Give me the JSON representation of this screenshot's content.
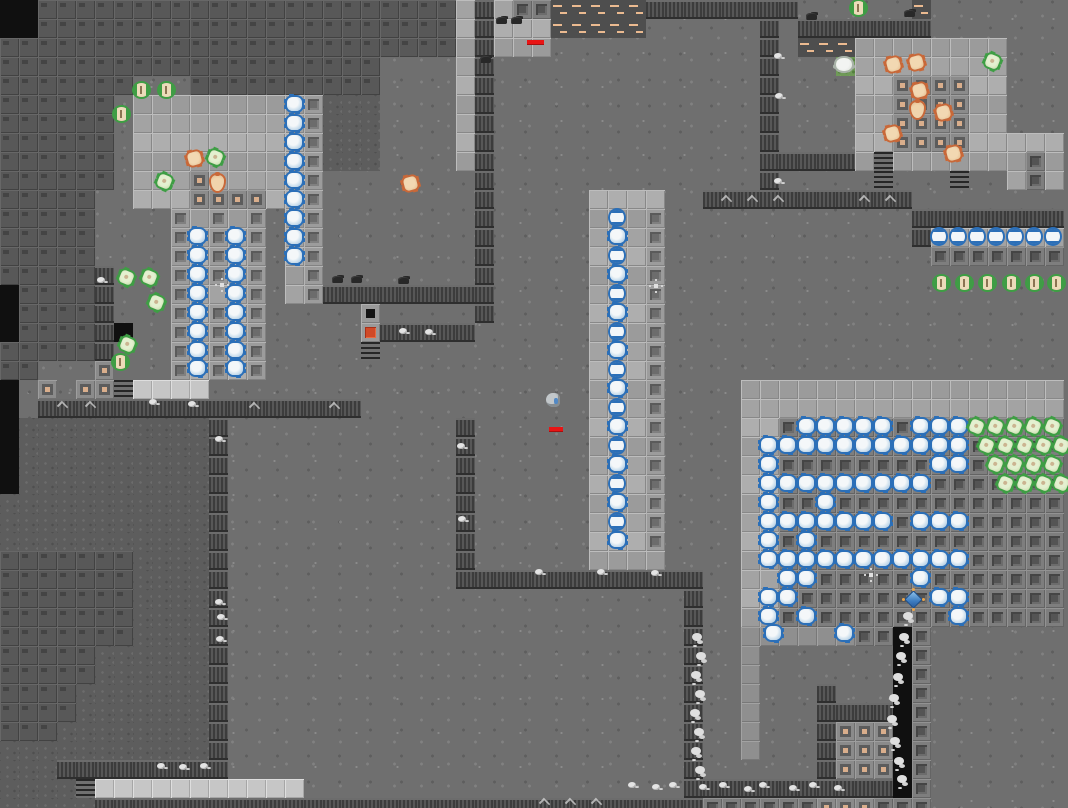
{
  "meta": {
    "title": "fortress-map-viewport",
    "tile_size": 19,
    "cols": 56,
    "rows": 43,
    "width": 1068,
    "height": 808
  },
  "palette": {
    "rough_floor": "#6f6f6f",
    "dark_rough_floor": "#5d5d5d",
    "rock": "#585858",
    "smooth_floor": "#a3a3a3",
    "bright_floor": "#c6c6c6",
    "wall_dark": "#3c3c3c",
    "wall_light": "#575757",
    "tan_accent": "#d9ae8c",
    "track_dash": "#ebba90",
    "blue_creature": "#2b6fb8",
    "green_creature": "#3e9e44",
    "orange_creature": "#c96838",
    "red_trap": "#d04a28",
    "health_red": "#e81414",
    "gem_blue": "#3d7cc0",
    "gem_dot_orange": "#e8a44c"
  },
  "legend": {
    "#": "rock-block",
    ".": "rough-floor",
    ",": "dark-rough-floor",
    "s": "smooth-floor",
    "S": "bright-floor",
    "m": "mid-floor",
    "i": "inset-floor",
    "I": "inset-floor-dark",
    "t": "tan-center-tile",
    "h": "hatch",
    "r": "red-trap",
    "w": "wall-band",
    "d": "track-dash-tile",
    "%": "stairs",
    "x": "void-black",
    "g": "mossy-tile"
  },
  "map": [
    "xx######################swsIIdddddwwwwwwww......d.......",
    "xx######################swsssddddd......w.wwwwwww.......",
    "########################swsss...........w.dddssssssss...",
    "####################....sw..............w...gssssssss...",
    "#######...##########....sw..............w....ssttttss...",
    "######.sssssssssi,,,....sw..............w....ssttttss...",
    "######.sssssssssi,,,....sw..............w....ssttttss...",
    "######.sssssssssi,,,....sw..............w....ssttttsssss",
    "######.sssssssssi,,,....sw..............wwwwws%sssssssIs",
    "######.ssstsssssi........w..............w.....%...%..sIs",
    "#####..sssttttssi........w.....ssss..wwwwwwwwwww........",
    "#####....isisi.si........w.....sssi.............wwwwwwww",
    "#####....isisi.si........w.....sssi.............wsssssss",
    "#####....isisi.si........w.....sssi..............IIIIIII",
    "#####w...isisi.si........w.....sssi.....................",
    "x####w...isssi.siwwwwwwwww.....sssi.....................",
    "x####w...isisi.....h.....w.....sssi.....................",
    "x####wx..isisi.....rwwwww......sssi.....................",
    "#####w...isisi.....%...........sssi.....................",
    "##...t...isisi.................sssi.....................",
    "x.t.tt%SSSS....................sssi....sssssssssssssssss",
    "x.wwwwwwwwwwwwwwwww............sssi....sssssssssssssssss",
    "x,,,,,,,,,,w............w......sssi....ssIIIIIIIIIIIIIII",
    "x,,,,,,,,,,w............w......sssi....ssIIIIIIIIIIIIIII",
    "x,,,,,,,,,,w............w......sssi....ssIIIIIIIIIIIIIII",
    "x,,,,,,,,,,w............w......sssi....ssIIIIIIIIIIIIIII",
    ",,,,,,,,,,,w............w......sssi....ssIIIIIIIIIIIIIII",
    ",,,,,,,,,,,w............w......sssi....ssIIIIIIIIIIIIIII",
    ",,,,,,,,,,,w............w......sssi....ssIIIIIIIIIIIIIII",
    "#######,,,,w............w......ssss....ssIIIIIIIIIIIIIII",
    "#######,,,,w............wwwwwwwwwwwww..ssIIIIIIIIIIIIIII",
    "#######,,,,w........................w..ssIIIIIIIIIIIIIII",
    "#######,,,,w........................w..ssIIIIIIIIIIIIIII",
    "#######,,,,w........................w..mmmmmmIIxI.......",
    "#####,,,,,,w........................w..m.......xI.......",
    "#####,,,,,,w........................w..m.......xI.......",
    "####,,,,,,,w........................w..m...w...xI.......",
    "####,,,,,,,w........................w..m...wwwwxI.......",
    "###,,,,,,,,w........................w..m...wtttxI.......",
    ",,,,,,,,,,,w........................w..m...wtttxI.......",
    ",,,wwwwwwwww........................w......wtttxI.......",
    ",,,,%SSSSSSSSSSS....................wwwwwwwwwwwxI.......",
    ",,,,,wwwwwwwwwwwwwwwwwwwwwwwwwwwwwwwwIIIIIItttIII......."
  ],
  "sprites": {
    "blue_bug": [
      [
        287,
        97
      ],
      [
        287,
        116
      ],
      [
        287,
        135
      ],
      [
        287,
        154
      ],
      [
        287,
        173
      ],
      [
        287,
        192
      ],
      [
        287,
        211
      ],
      [
        287,
        230
      ],
      [
        287,
        249
      ],
      [
        190,
        229
      ],
      [
        190,
        248
      ],
      [
        190,
        267
      ],
      [
        190,
        286
      ],
      [
        190,
        305
      ],
      [
        190,
        324
      ],
      [
        190,
        343
      ],
      [
        190,
        361
      ],
      [
        228,
        229
      ],
      [
        228,
        248
      ],
      [
        228,
        267
      ],
      [
        228,
        286
      ],
      [
        228,
        305
      ],
      [
        228,
        324
      ],
      [
        228,
        343
      ],
      [
        228,
        361
      ],
      [
        610,
        229
      ],
      [
        610,
        267
      ],
      [
        610,
        305
      ],
      [
        610,
        343
      ],
      [
        610,
        381
      ],
      [
        610,
        419
      ],
      [
        610,
        457
      ],
      [
        610,
        495
      ],
      [
        610,
        533
      ],
      [
        799,
        419
      ],
      [
        818,
        419
      ],
      [
        837,
        419
      ],
      [
        856,
        419
      ],
      [
        875,
        419
      ],
      [
        913,
        419
      ],
      [
        932,
        419
      ],
      [
        951,
        419
      ],
      [
        761,
        438
      ],
      [
        780,
        438
      ],
      [
        799,
        438
      ],
      [
        818,
        438
      ],
      [
        837,
        438
      ],
      [
        856,
        438
      ],
      [
        875,
        438
      ],
      [
        894,
        438
      ],
      [
        913,
        438
      ],
      [
        932,
        438
      ],
      [
        951,
        438
      ],
      [
        761,
        457
      ],
      [
        932,
        457
      ],
      [
        951,
        457
      ],
      [
        761,
        476
      ],
      [
        780,
        476
      ],
      [
        799,
        476
      ],
      [
        818,
        476
      ],
      [
        837,
        476
      ],
      [
        856,
        476
      ],
      [
        875,
        476
      ],
      [
        894,
        476
      ],
      [
        913,
        476
      ],
      [
        761,
        495
      ],
      [
        818,
        495
      ],
      [
        761,
        514
      ],
      [
        780,
        514
      ],
      [
        799,
        514
      ],
      [
        818,
        514
      ],
      [
        837,
        514
      ],
      [
        856,
        514
      ],
      [
        875,
        514
      ],
      [
        913,
        514
      ],
      [
        932,
        514
      ],
      [
        951,
        514
      ],
      [
        761,
        533
      ],
      [
        799,
        533
      ],
      [
        761,
        552
      ],
      [
        780,
        552
      ],
      [
        799,
        552
      ],
      [
        818,
        552
      ],
      [
        837,
        552
      ],
      [
        856,
        552
      ],
      [
        875,
        552
      ],
      [
        894,
        552
      ],
      [
        913,
        552
      ],
      [
        932,
        552
      ],
      [
        951,
        552
      ],
      [
        780,
        571
      ],
      [
        799,
        571
      ],
      [
        913,
        571
      ],
      [
        761,
        590
      ],
      [
        780,
        590
      ],
      [
        932,
        590
      ],
      [
        951,
        590
      ],
      [
        761,
        609
      ],
      [
        799,
        609
      ],
      [
        951,
        609
      ],
      [
        766,
        626
      ],
      [
        837,
        626
      ]
    ],
    "blue_egg": [
      [
        610,
        210
      ],
      [
        610,
        248
      ],
      [
        610,
        286
      ],
      [
        610,
        324
      ],
      [
        610,
        362
      ],
      [
        610,
        400
      ],
      [
        610,
        438
      ],
      [
        610,
        476
      ],
      [
        610,
        514
      ],
      [
        932,
        229
      ],
      [
        951,
        229
      ],
      [
        970,
        229
      ],
      [
        989,
        229
      ],
      [
        1008,
        229
      ],
      [
        1027,
        229
      ],
      [
        1046,
        229
      ]
    ],
    "green_bug": [
      [
        134,
        83
      ],
      [
        159,
        83
      ],
      [
        114,
        107
      ],
      [
        113,
        355
      ],
      [
        851,
        1
      ],
      [
        934,
        276
      ],
      [
        957,
        276
      ],
      [
        980,
        276
      ],
      [
        1004,
        276
      ],
      [
        1027,
        276
      ],
      [
        1049,
        276
      ]
    ],
    "green_spider": [
      [
        120,
        271
      ],
      [
        143,
        271
      ],
      [
        150,
        296
      ],
      [
        121,
        338
      ],
      [
        209,
        151
      ],
      [
        158,
        175
      ],
      [
        986,
        55
      ],
      [
        970,
        420
      ],
      [
        989,
        420
      ],
      [
        1008,
        420
      ],
      [
        1027,
        420
      ],
      [
        1046,
        420
      ],
      [
        980,
        439
      ],
      [
        999,
        439
      ],
      [
        1018,
        439
      ],
      [
        1037,
        439
      ],
      [
        1055,
        439
      ],
      [
        989,
        458
      ],
      [
        1008,
        458
      ],
      [
        1027,
        458
      ],
      [
        1046,
        458
      ],
      [
        999,
        477
      ],
      [
        1018,
        477
      ],
      [
        1037,
        477
      ],
      [
        1055,
        477
      ]
    ],
    "orange_crab": [
      [
        188,
        152
      ],
      [
        404,
        177
      ],
      [
        887,
        58
      ],
      [
        910,
        56
      ],
      [
        913,
        84
      ],
      [
        937,
        106
      ],
      [
        947,
        147
      ],
      [
        886,
        127
      ]
    ],
    "orange_sack": [
      [
        211,
        175
      ],
      [
        911,
        102
      ]
    ],
    "white_creature": [
      [
        836,
        58
      ]
    ],
    "player": [
      [
        546,
        393
      ]
    ],
    "gem_unit": [
      [
        905,
        591
      ]
    ],
    "web": [
      [
        213,
        276
      ],
      [
        647,
        277
      ],
      [
        862,
        566
      ]
    ],
    "dark_item": [
      [
        332,
        276
      ],
      [
        351,
        276
      ],
      [
        398,
        277
      ],
      [
        496,
        17
      ],
      [
        511,
        17
      ],
      [
        806,
        13
      ],
      [
        904,
        10
      ],
      [
        480,
        56
      ]
    ],
    "rubble": [
      [
        149,
        399
      ],
      [
        188,
        401
      ],
      [
        215,
        436
      ],
      [
        457,
        443
      ],
      [
        458,
        516
      ],
      [
        535,
        569
      ],
      [
        597,
        569
      ],
      [
        651,
        570
      ],
      [
        215,
        599
      ],
      [
        217,
        614
      ],
      [
        216,
        636
      ],
      [
        157,
        763
      ],
      [
        179,
        764
      ],
      [
        200,
        763
      ],
      [
        97,
        277
      ],
      [
        774,
        53
      ],
      [
        775,
        93
      ],
      [
        774,
        178
      ],
      [
        399,
        328
      ],
      [
        425,
        329
      ],
      [
        628,
        782
      ],
      [
        652,
        784
      ],
      [
        669,
        782
      ],
      [
        699,
        784
      ],
      [
        719,
        782
      ],
      [
        744,
        786
      ],
      [
        759,
        782
      ],
      [
        789,
        785
      ],
      [
        809,
        782
      ],
      [
        834,
        785
      ]
    ],
    "mist": [
      [
        692,
        633
      ],
      [
        696,
        652
      ],
      [
        691,
        671
      ],
      [
        695,
        690
      ],
      [
        690,
        709
      ],
      [
        694,
        728
      ],
      [
        691,
        747
      ],
      [
        695,
        766
      ],
      [
        903,
        612
      ],
      [
        899,
        633
      ],
      [
        896,
        652
      ],
      [
        893,
        673
      ],
      [
        889,
        694
      ],
      [
        887,
        715
      ],
      [
        890,
        737
      ],
      [
        894,
        757
      ],
      [
        897,
        775
      ]
    ],
    "chevron": [
      [
        58,
        402
      ],
      [
        86,
        402
      ],
      [
        250,
        403
      ],
      [
        330,
        403
      ],
      [
        722,
        196
      ],
      [
        748,
        196
      ],
      [
        774,
        196
      ],
      [
        860,
        196
      ],
      [
        886,
        196
      ],
      [
        540,
        799
      ],
      [
        566,
        799
      ],
      [
        592,
        799
      ]
    ],
    "health_bars": [
      [
        527,
        40,
        17
      ],
      [
        549,
        427,
        14
      ]
    ]
  }
}
